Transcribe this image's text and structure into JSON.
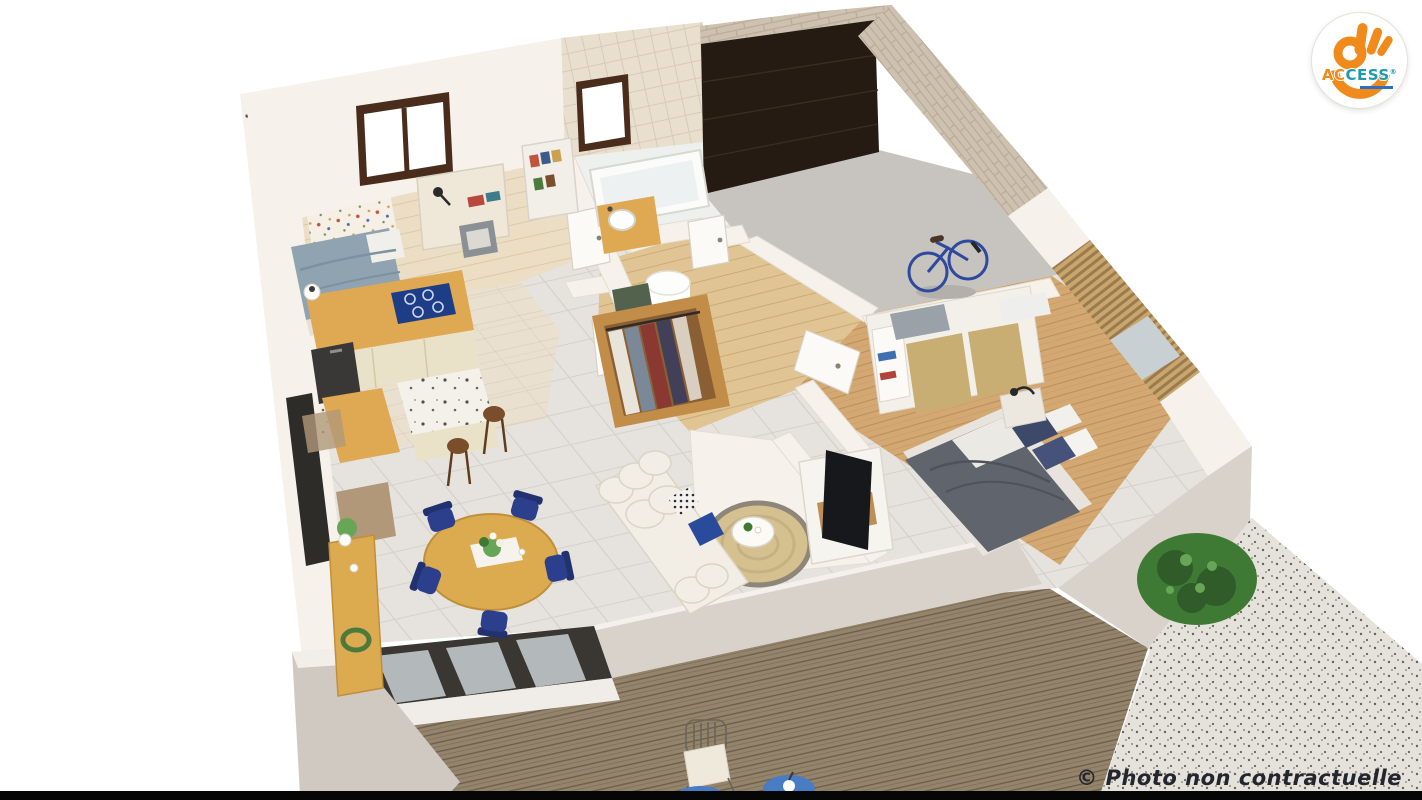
{
  "watermark": {
    "text": "© Photo non contractuelle"
  },
  "logo": {
    "brand_prefix": "AC",
    "brand_suffix": "CESS",
    "registered": "®"
  },
  "scene": {
    "type": "3d-isometric-floor-plan-render",
    "rooms": [
      "bedroom-office",
      "kitchen",
      "bathroom",
      "hallway-dressing",
      "garage",
      "bedroom",
      "living-dining",
      "terrace-deck",
      "gravel-patio"
    ],
    "objects": [
      "single-bed",
      "desk",
      "desk-chair",
      "ladder-shelf",
      "floral-accent-wall",
      "kitchen-counter",
      "cooktop",
      "kitchen-island",
      "bar-stools",
      "bathtub",
      "washbasin",
      "open-wardrobe",
      "laundry-basket",
      "garage-sectional-door",
      "bicycle",
      "double-bed",
      "nightstand",
      "sliding-wardrobe",
      "tv-stand",
      "tv",
      "sofa",
      "jute-rug",
      "coffee-table",
      "round-dining-table",
      "dining-chairs",
      "console-table",
      "sliding-glass-doors",
      "outdoor-chair",
      "blue-side-tables",
      "bush-plant"
    ]
  },
  "colors": {
    "bg": "#ffffff",
    "bar": "#060606",
    "wallWhite": "#f6f2eb",
    "wallShade": "#dcd5ca",
    "parapet": "#d8d2ca",
    "tileWall": "#e9dfcf",
    "tileWallLine": "#d8cab6",
    "stone": "#cdc1b0",
    "stoneLine": "#b9ab97",
    "garageDoor": "#251b13",
    "garageFloor": "#c7c3bf",
    "tileFloor": "#e6e3de",
    "tileLine": "#d5d1cb",
    "paleWood": "#ecdec4",
    "paleWoodLine": "#dcc9a8",
    "oakWood": "#d3a873",
    "oakLine": "#bd9057",
    "hallWood": "#e0c494",
    "deckWood": "#94846b",
    "deckLine": "#6d5f4c",
    "gravel": "#e5e2db",
    "gravelDot": "#67625a",
    "counterWood": "#dfa852",
    "cabinetCream": "#eae1c9",
    "cooktop": "#1e3d87",
    "darkUnit": "#2e2c29",
    "navy": "#2c3f8d",
    "navyLight": "#4a7cc4",
    "bedBlanket": "#8fa3b0",
    "duvet": "#60646c",
    "duvetWhite": "#ebe9e4",
    "pillowNavy": "#3c4968",
    "sofa": "#f2eee5",
    "sofaEdge": "#dcd4c4",
    "rug": "#d5c08f",
    "rugRim": "#8e8678",
    "tableWood": "#dcaa4f",
    "terrazzo": "#f4f1ea",
    "wardrobe": "#c28c49",
    "wardrobeDark": "#8a5f33",
    "closetWhite": "#f3f0ea",
    "gold": "#c9ae74",
    "green": "#3f7a34",
    "greenDark": "#2f5c28",
    "greenLight": "#67a557",
    "glassGray": "#c9d0d3",
    "frameDark": "#3a3733",
    "matBrown": "#b09878",
    "stoolWood": "#7a4e2a",
    "towelGray": "#9aa1a8",
    "tvDark": "#17181b",
    "slat": "#c9a66b",
    "slatGap": "#9a7b4f",
    "steel": "#6a6458",
    "white": "#ffffff",
    "watermark": "#23262e",
    "logoOrange": "#ef8a1b",
    "logoTeal": "#1e9ab0",
    "logoBlue": "#2f6fc1"
  }
}
